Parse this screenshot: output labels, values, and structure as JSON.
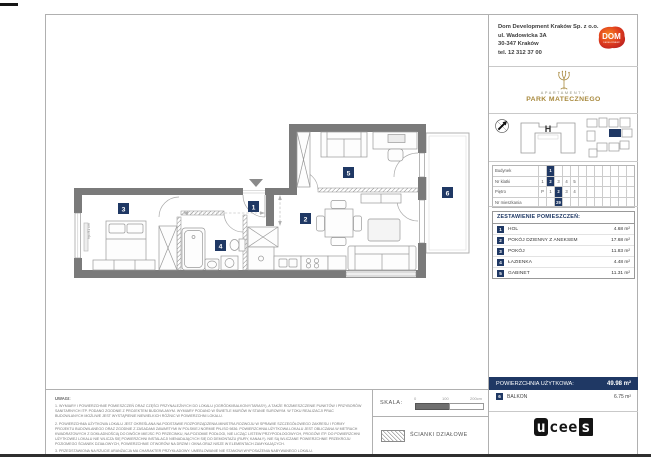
{
  "company": {
    "name": "Dom Development Kraków Sp. z o.o.",
    "address1": "ul. Wadowicka 3A",
    "address2": "30-347 Kraków",
    "phone": "tel. 12 312 37 00"
  },
  "dom_logo": {
    "text": "DOM",
    "subtext": "DEVELOPMENT"
  },
  "brand": {
    "upper": "APARTAMENTY",
    "name": "PARK MATECZNEGO"
  },
  "overview": {
    "building_letter": "H"
  },
  "location_table": {
    "rows": [
      {
        "label": "Budynek",
        "cells": [
          "",
          "1",
          "",
          "",
          "",
          "",
          "",
          "",
          "",
          "",
          "",
          ""
        ],
        "hl": 1
      },
      {
        "label": "Nr klatki",
        "cells": [
          "1",
          "2",
          "3",
          "4",
          "5",
          "",
          "",
          "",
          "",
          "",
          "",
          ""
        ],
        "hl": 1
      },
      {
        "label": "Piętro",
        "cells": [
          "P",
          "1",
          "2",
          "3",
          "4",
          "",
          "",
          "",
          "",
          "",
          "",
          ""
        ],
        "hl": 2
      },
      {
        "label": "Nr mieszkania",
        "cells": [
          "",
          "",
          "29",
          "",
          "",
          "",
          "",
          "",
          "",
          "",
          "",
          ""
        ],
        "hl": 2
      }
    ]
  },
  "rooms": {
    "title": "ZESTAWIENIE POMIESZCZEŃ:",
    "items": [
      {
        "no": "1",
        "name": "HOL",
        "area": "4.68 m²"
      },
      {
        "no": "2",
        "name": "POKÓJ DZIENNY Z ANEKSEM",
        "area": "17.68 m²"
      },
      {
        "no": "3",
        "name": "POKÓJ",
        "area": "11.83 m²"
      },
      {
        "no": "4",
        "name": "ŁAZIENKA",
        "area": "4.48 m²"
      },
      {
        "no": "5",
        "name": "GABINET",
        "area": "11.31 m²"
      }
    ]
  },
  "summary": {
    "label": "POWIERZCHNIA UŻYTKOWA:",
    "value": "49.98 m²"
  },
  "balcony": {
    "no": "6",
    "name": "BALKON",
    "area": "6.75 m²"
  },
  "footer_logo": {
    "left": "u",
    "mid": "cee",
    "right": "s"
  },
  "notes": {
    "title": "UWAGI:",
    "lines": [
      "1. WYMIARY I POWIERZCHNIE POMIESZCZEŃ ORAZ CZĘŚCI PRZYNALEŻNYCH DO LOKALU (OGRÓDKI/BALKONY/TARASY), A TAKŻE ROZMIESZCZENIE PUNKTÓW I PRZYBORÓW SANITARNYCH ITP. PODANO ZGODNIE Z PROJEKTEM BUDOWLANYM. WYMIARY PODANO W ŚWIETLE MURÓW W STANIE SUROWYM. W TOKU REALIZACJI PRAC BUDOWLANYCH MOŻLIWE JEST WYSTĄPIENIE NIEWIELKICH RÓŻNIC W POWIERZCHNI LOKALU.",
      "2. POWIERZCHNIA UŻYTKOWA LOKALU JEST OKREŚLANA NA PODSTAWIE ROZPORZĄDZENIA MINISTRA ROZWOJU W SPRAWIE SZCZEGÓŁOWEGO ZAKRESU I FORMY PROJEKTU BUDOWLANEGO ORAZ ZGODNIE Z ZASADAMI ZAWARTYMI W POLSKIEJ NORMIE PN-ISO 9836. POWIERZCHNIA UŻYTKOWA LOKALU JEST OBLICZANA W METRACH KWADRATOWYCH Z DOKŁADNOŚCIĄ DO DWÓCH MIEJSC PO PRZECINKU, NA POZIOMIE PODŁOGI, NIE LICZĄC LISTEW PRZYPODŁOGOWYCH, PROGÓW ITP. DO POWIERZCHNI UŻYTKOWEJ LOKALU NIE WLICZA SIĘ POWIERZCHNI INSTALACJI NIENADAJĄCYCH SIĘ DO DEMONTAŻU (RURY, KANAŁY). NIE SĄ WLICZANE POWIERZCHNIE PRZEKROJU POZIOMEGO ŚCIANEK DZIAŁOWYCH, POWIERZCHNIE OTWORÓW NA DRZWI I OKNA ORAZ NISZE W ELEMENTACH ZAMYKAJĄCYCH.",
      "3. PRZEDSTAWIONA NA RZUCIE ARANŻACJA MA CHARAKTER PRZYKŁADOWY. UMEBLOWANIE NIE STANOWI WYPOSAŻENIA NABYWANEGO LOKALU."
    ]
  },
  "scale": {
    "label": "SKALA:",
    "t0": "0",
    "t1": "100",
    "t2": "200cm"
  },
  "legend": {
    "partitions": "ŚCIANKI DZIAŁOWE"
  },
  "plan": {
    "badges": {
      "b1": "1",
      "b2": "2",
      "b3": "3",
      "b4": "4",
      "b5": "5",
      "b6": "6"
    },
    "window_label": "hp=91 cm"
  },
  "colors": {
    "navy": "#1f3864",
    "wall": "#7a7a7a",
    "brand_gold": "#a8893d",
    "dom_red": "#d42b1e"
  }
}
